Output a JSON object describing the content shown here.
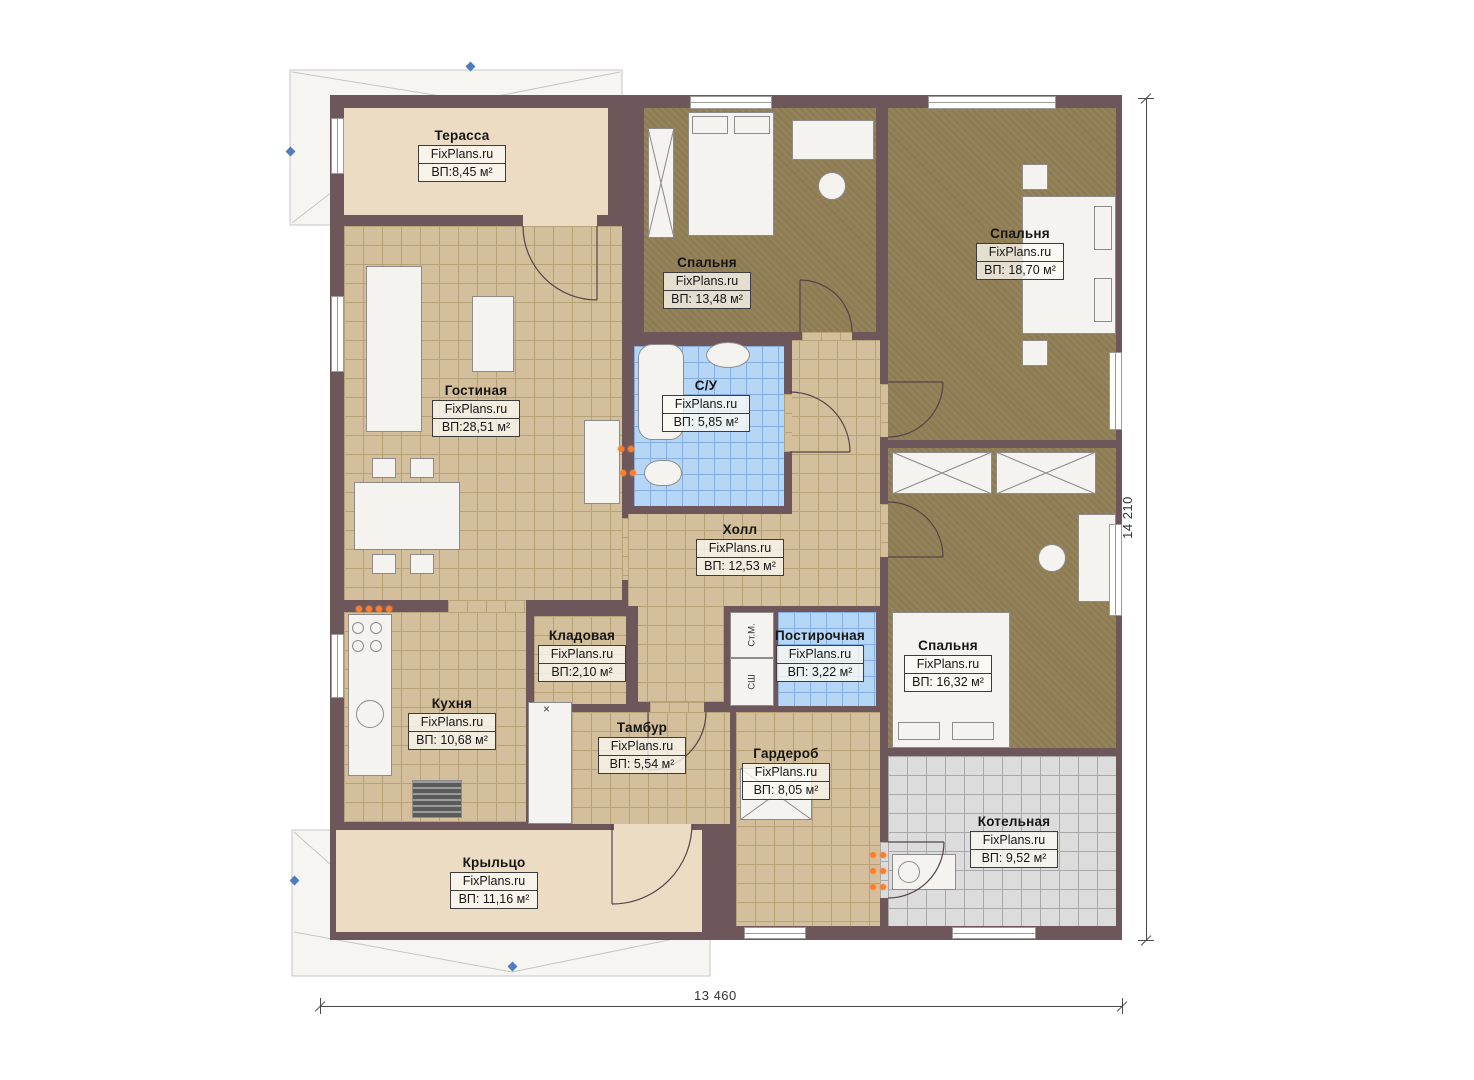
{
  "plan": {
    "brand": "FixPlans.ru",
    "rooms": {
      "terrace": {
        "name": "Терасса",
        "area": "ВП:8,45 м²"
      },
      "living": {
        "name": "Гостиная",
        "area": "ВП:28,51 м²"
      },
      "bedroom1": {
        "name": "Спальня",
        "area": "ВП: 13,48 м²"
      },
      "bedroom2": {
        "name": "Спальня",
        "area": "ВП: 18,70 м²"
      },
      "bathroom": {
        "name": "С/У",
        "area": "ВП: 5,85 м²"
      },
      "hall": {
        "name": "Холл",
        "area": "ВП: 12,53 м²"
      },
      "storage": {
        "name": "Кладовая",
        "area": "ВП:2,10 м²"
      },
      "laundry": {
        "name": "Постирочная",
        "area": "ВП: 3,22 м²"
      },
      "bedroom3": {
        "name": "Спальня",
        "area": "ВП: 16,32 м²"
      },
      "kitchen": {
        "name": "Кухня",
        "area": "ВП: 10,68 м²"
      },
      "vestibule": {
        "name": "Тамбур",
        "area": "ВП: 5,54 м²"
      },
      "wardrobe": {
        "name": "Гардероб",
        "area": "ВП: 8,05 м²"
      },
      "boiler": {
        "name": "Котельная",
        "area": "ВП: 9,52 м²"
      },
      "porch": {
        "name": "Крыльцо",
        "area": "ВП: 11,16 м²"
      }
    },
    "appliances": {
      "washing_machine": "Ст.М.",
      "dryer": "СШ",
      "cross_marker": "×"
    },
    "dimensions": {
      "bottom_width": "13 460",
      "right_height": "14 210"
    },
    "colors": {
      "wall": "#6e575b",
      "tile_tan": "#d3bf9b",
      "carpet_brown": "#8e7c53",
      "tile_blue": "#b5d7f5",
      "tile_gray": "#dcdcdc",
      "deck_beige": "#ecdcc3",
      "marker_blue": "#4f7cba",
      "socket_orange": "#ff7d2e"
    }
  }
}
